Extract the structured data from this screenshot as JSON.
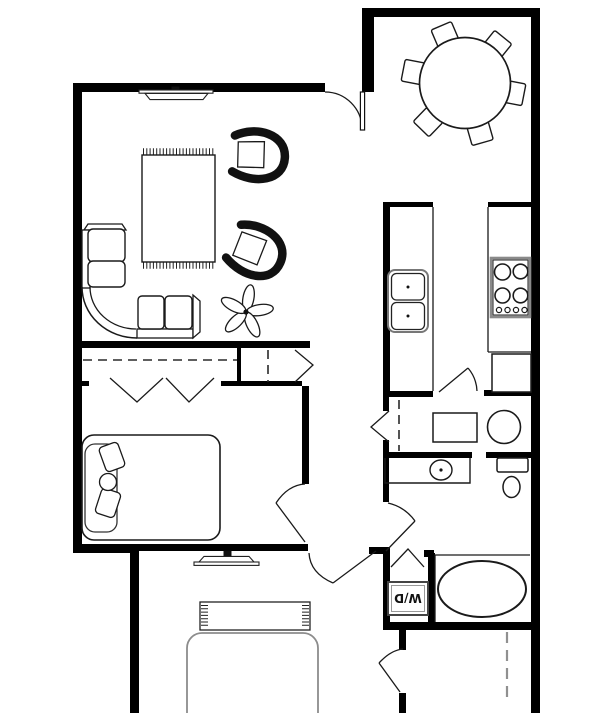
{
  "meta": {
    "drawing": "apartment floor plan",
    "view": "top-down plan view"
  },
  "colors": {
    "background": "#ffffff",
    "walls": "#000000",
    "line": "#1a1a1a",
    "muted_gray": "#8c8c8c",
    "appliance_border": "#8a8a8a"
  },
  "labels": {
    "washer_dryer": "W/D"
  },
  "rooms": [
    {
      "name": "living-room",
      "items": [
        "sectional-sofa",
        "area-rug-with-fringe",
        "barrel-chair",
        "barrel-chair",
        "potted-plant",
        "ceiling-light",
        "entry-door"
      ]
    },
    {
      "name": "dining-area",
      "items": [
        "round-table",
        "six-chairs"
      ]
    },
    {
      "name": "kitchen",
      "items": [
        "island-counter",
        "double-basin-sink",
        "four-burner-stove",
        "refrigerator",
        "swing-door"
      ]
    },
    {
      "name": "bedroom-1",
      "items": [
        "bed-with-pillows",
        "wide-closet-bifold-doors",
        "closet-rod",
        "side-closet-bifold-door",
        "swing-door"
      ]
    },
    {
      "name": "hallway",
      "items": [
        "linen-closet-bifold-door",
        "closet-rod"
      ]
    },
    {
      "name": "utility-nook",
      "items": [
        "washer-box",
        "round-appliance"
      ]
    },
    {
      "name": "bathroom",
      "items": [
        "vanity-with-sink",
        "toilet",
        "swing-door"
      ]
    },
    {
      "name": "laundry-closet",
      "items": [
        "washer-dryer-unit",
        "bifold-door"
      ]
    },
    {
      "name": "tub-area",
      "items": [
        "bathtub"
      ]
    },
    {
      "name": "bedroom-2",
      "items": [
        "bed",
        "fringed-rug",
        "ceiling-light",
        "closet-dashed-rod",
        "swing-door"
      ]
    }
  ]
}
